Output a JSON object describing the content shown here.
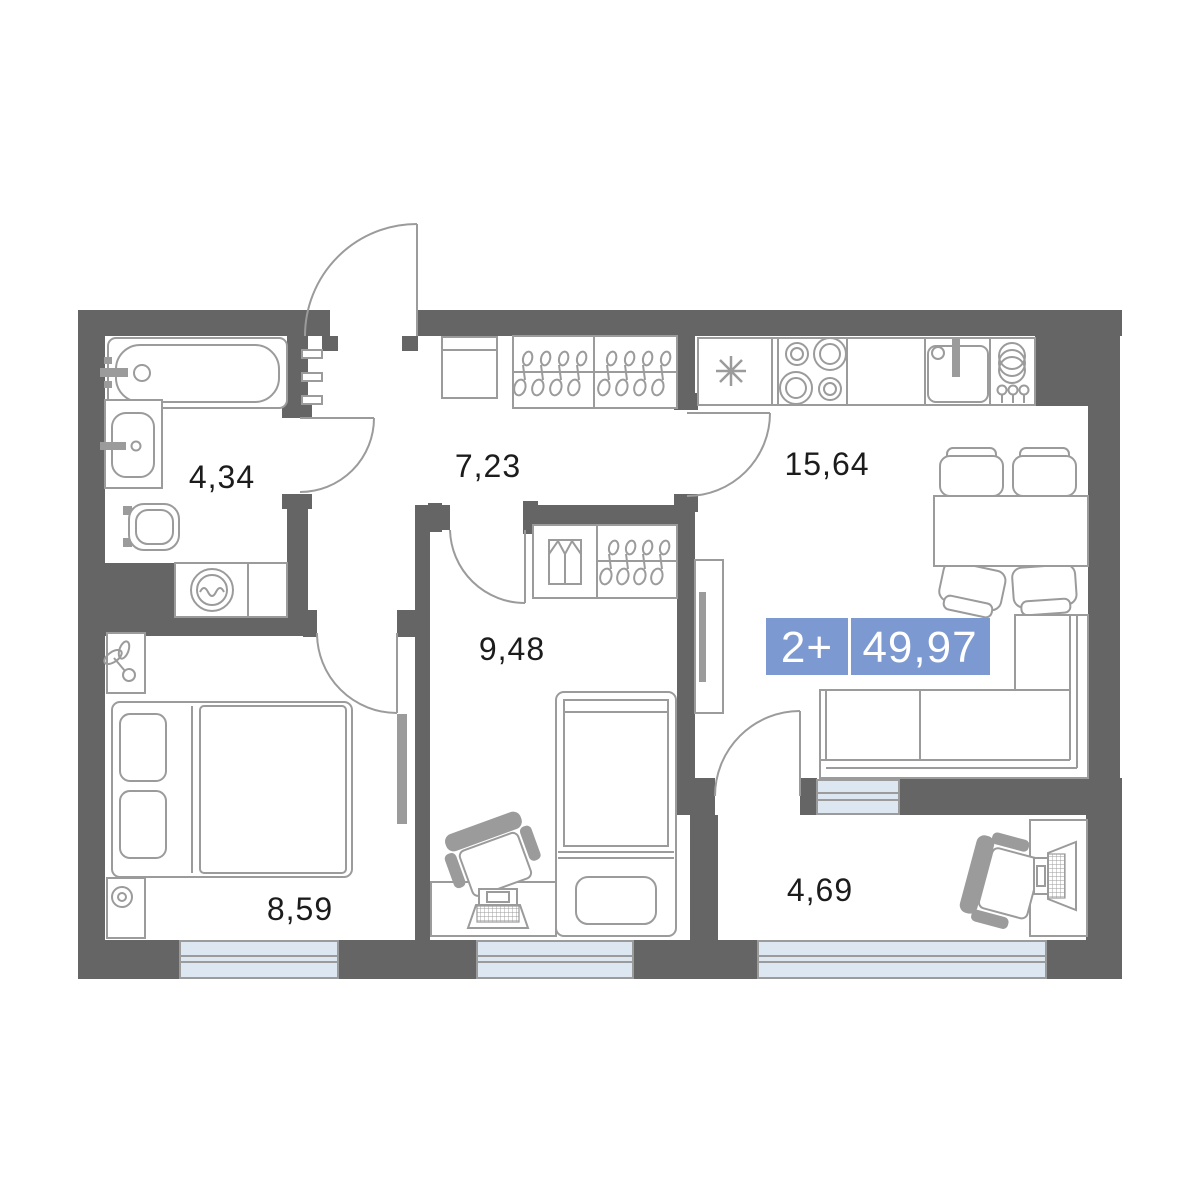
{
  "floorplan": {
    "badge": {
      "rooms": "2+",
      "area": "49,97",
      "color": "#7d99d1"
    },
    "rooms": [
      {
        "key": "bathroom",
        "area": "4,34"
      },
      {
        "key": "hallway",
        "area": "7,23"
      },
      {
        "key": "kitchen-living",
        "area": "15,64"
      },
      {
        "key": "bedroom-second",
        "area": "9,48"
      },
      {
        "key": "bedroom-master",
        "area": "8,59"
      },
      {
        "key": "loggia",
        "area": "4,69"
      }
    ],
    "icons": [
      "bathtub-icon",
      "sink-icon",
      "toilet-icon",
      "washing-machine-icon",
      "towel-rail-icon",
      "bench-icon",
      "hanger-icon",
      "folded-clothes-icon",
      "fridge-snowflake-icon",
      "stove-burners-icon",
      "kitchen-sink-icon",
      "dish-rack-icon",
      "dining-table-icon",
      "chair-icon",
      "sofa-icon",
      "tv-icon",
      "double-bed-icon",
      "single-bed-icon",
      "pillow-icon",
      "plant-icon",
      "lamp-icon",
      "desk-icon",
      "laptop-icon",
      "monitor-icon",
      "door-arc-icon",
      "window-icon"
    ],
    "colors": {
      "wall": "#656565",
      "line": "#9b9b9b",
      "window": "#dce7f2",
      "text": "#1c1c1c",
      "badge": "#7d99d1"
    }
  }
}
